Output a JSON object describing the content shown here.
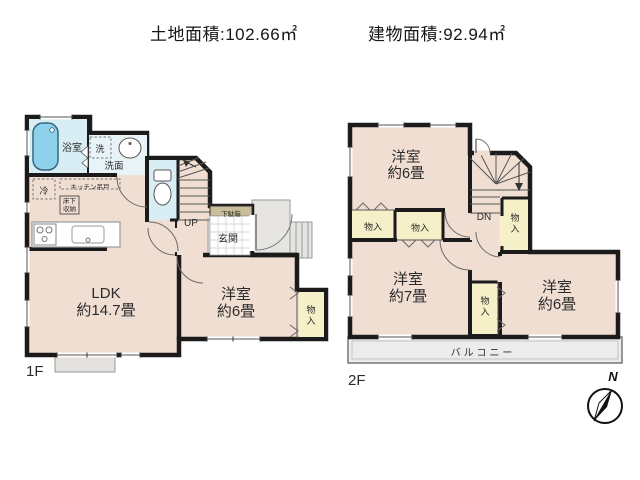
{
  "header": {
    "land_area": "土地面積:102.66㎡",
    "building_area": "建物面積:92.94㎡"
  },
  "floor1": {
    "label": "1F",
    "bathroom": "浴室",
    "washer": "洗",
    "washroom": "洗面",
    "fridge": "冷",
    "kitchen_cabinet": "キッチン吊戸",
    "underfloor_storage": "床下収納",
    "stairs": "UP",
    "shoe_box": "下駄箱",
    "entrance": "玄関",
    "ldk": {
      "name": "LDK",
      "size": "約14.7畳"
    },
    "bedroom": {
      "name": "洋室",
      "size": "約6畳"
    },
    "closet": "物入"
  },
  "floor2": {
    "label": "2F",
    "stairs": "DN",
    "bedroom_top": {
      "name": "洋室",
      "size": "約6畳"
    },
    "bedroom_left": {
      "name": "洋室",
      "size": "約7畳"
    },
    "bedroom_right": {
      "name": "洋室",
      "size": "約6畳"
    },
    "closet_left": "物入",
    "closet_mid": "物入",
    "closet_stairs": "物入",
    "closet_bottom": "物入",
    "balcony": "バルコニー"
  },
  "compass": {
    "north": "N"
  },
  "palette": {
    "room_fill": "#f1ded3",
    "wet_fill": "#d9edf5",
    "washroom_fill": "#e8f3f8",
    "tub_fill": "#8ed1eb",
    "closet_fill": "#f6f0c8",
    "shoe_box_fill": "#cabd9c",
    "porch_fill": "#e7e5e2",
    "balcony_fill": "#ececec",
    "wall": "#1b1b1b"
  }
}
